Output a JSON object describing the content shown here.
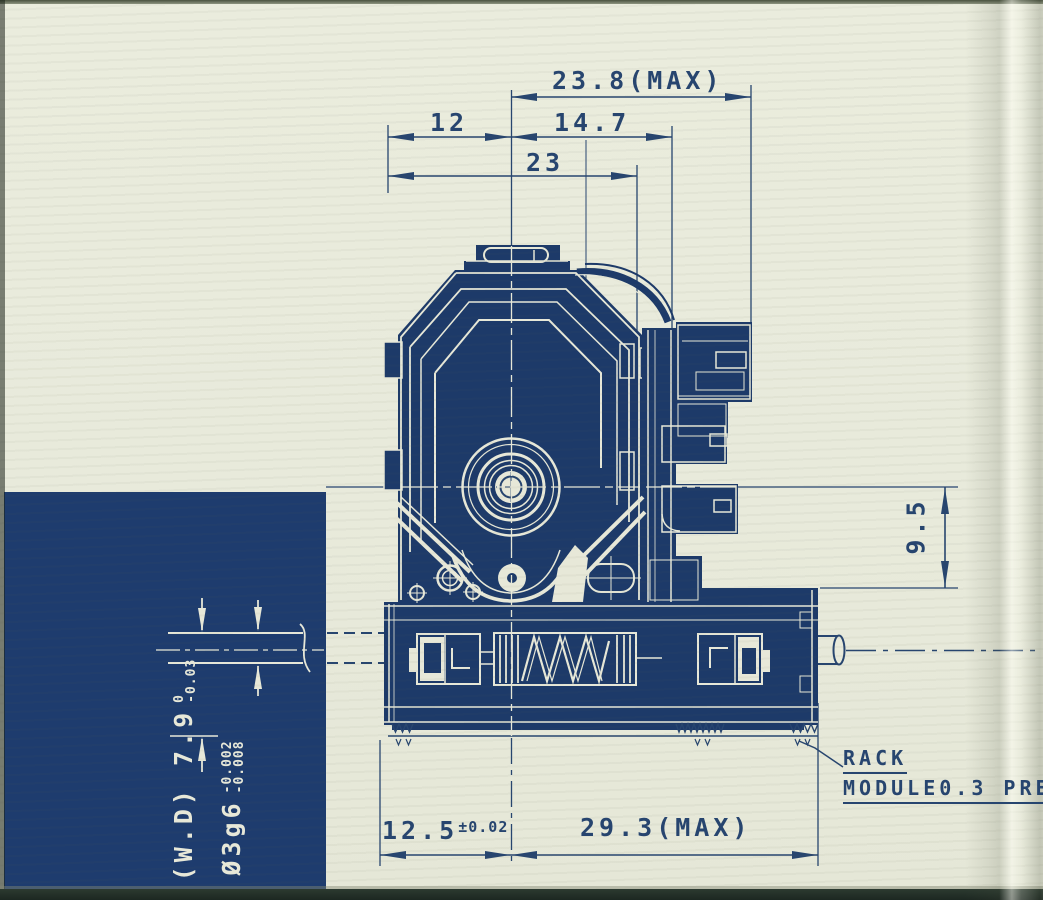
{
  "dims": {
    "top_max": "23.8(MAX)",
    "d12": "12",
    "d14_7": "14.7",
    "d23": "23",
    "d9_5": "9.5",
    "d12_5": "12.5",
    "d12_5_tol": "±0.02",
    "d29_3": "29.3(MAX)",
    "wd_prefix": "(W.D)",
    "wd_value": "7.9",
    "wd_tol_top": "0",
    "wd_tol_bottom": "-0.03",
    "shaft_value": "Ø3g6",
    "shaft_tol_top": "-0.002",
    "shaft_tol_bottom": "-0.008"
  },
  "notes": {
    "rack_line1": "RACK",
    "rack_line2": "MODULE0.3 PRE"
  },
  "colors": {
    "ink": "#27456f",
    "ink_fill": "#1d3a69",
    "navy_block": "#1e3c6e",
    "paper": "#e8eadb",
    "cream_line": "#e7e8d8"
  }
}
